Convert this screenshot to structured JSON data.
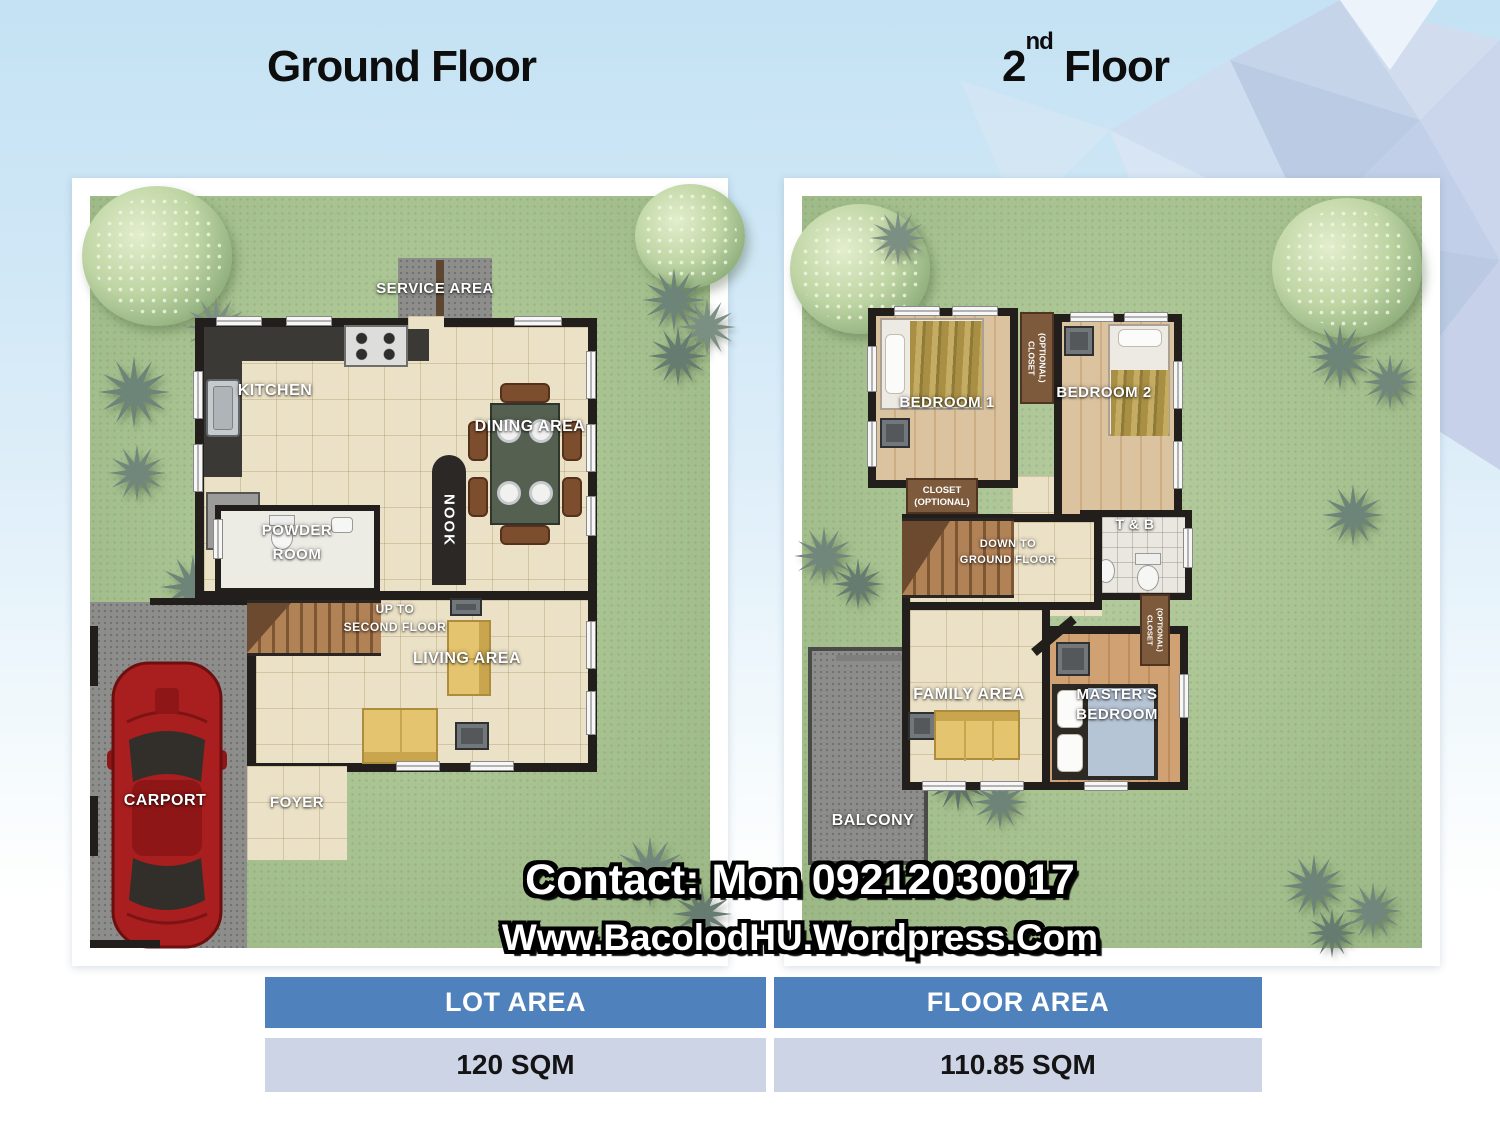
{
  "titles": {
    "ground_floor": "Ground Floor",
    "second_floor_base": "2",
    "second_floor_sup": "nd",
    "second_floor_rest": " Floor"
  },
  "ground_floor": {
    "service_area": "SERVICE AREA",
    "kitchen": "KITCHEN",
    "nook": "NOOK",
    "dining_area": "DINING AREA",
    "powder_line1": "POWDER",
    "powder_line2": "ROOM",
    "stairs_line1": "UP TO",
    "stairs_line2": "SECOND FLOOR",
    "living_area": "LIVING AREA",
    "foyer": "FOYER",
    "carport": "CARPORT"
  },
  "second_floor": {
    "bedroom1": "BEDROOM 1",
    "bedroom2": "BEDROOM 2",
    "closet_line1": "CLOSET",
    "closet_line2": "(OPTIONAL)",
    "tb": "T & B",
    "stairs_line1": "DOWN TO",
    "stairs_line2": "GROUND FLOOR",
    "family_area": "FAMILY AREA",
    "master_line1": "MASTER'S",
    "master_line2": "BEDROOM",
    "balcony": "BALCONY"
  },
  "contact": {
    "line1": "Contact: Mon 09212030017",
    "line2": "Www.BacolodHU.Wordpress.Com"
  },
  "table": {
    "headers": [
      "LOT AREA",
      "FLOOR AREA"
    ],
    "values": [
      "120 SQM",
      "110.85 SQM"
    ]
  },
  "colors": {
    "table_header_bg": "#4f81bd",
    "table_row_bg": "#cdd4e6",
    "lawn_green": "#a7c290",
    "wall_black": "#211e1b",
    "floor_tile": "#ebe1c6",
    "background_blue": "#c4e2f4",
    "car_red": "#a91e1e"
  }
}
